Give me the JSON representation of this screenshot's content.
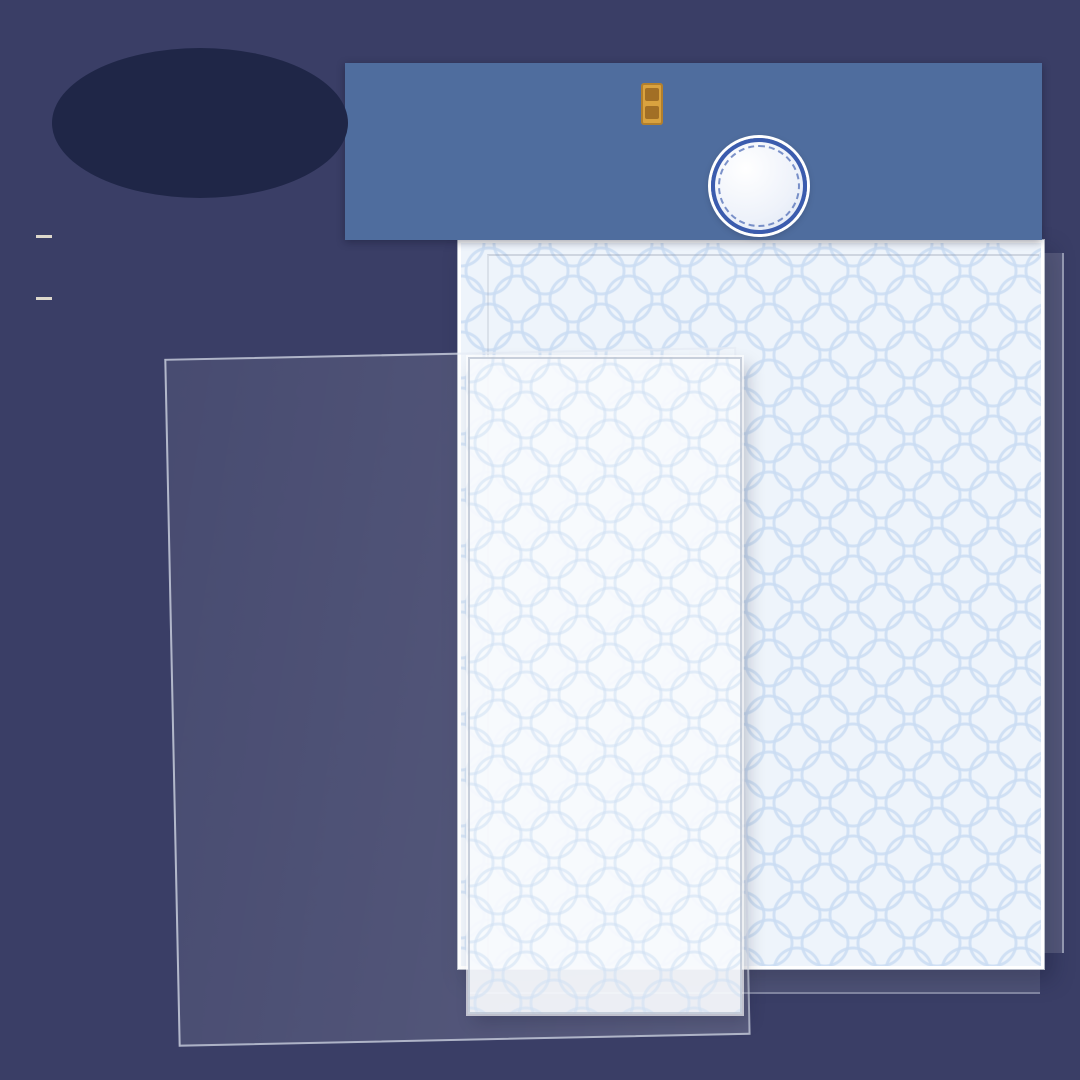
{
  "page": {
    "bg": "#3a3e66"
  },
  "store_badge": {
    "line1": "Treasure",
    "line2": "Store",
    "bg": "#1f2647",
    "text_color": "#f3ecd9"
  },
  "specs": [
    {
      "bullet": "•",
      "label": "scene card *1",
      "size": "140X180MM"
    },
    {
      "bullet": "•",
      "label": "PET sticker *2",
      "size": "125X150MM"
    }
  ],
  "banner": {
    "title_cn": "国风造景贴纸",
    "subtitle_line1": "Storage and Landscape",
    "subtitle_line2": "Stickers Series",
    "subtitle_cn": "珍宝阁篇",
    "version": "3.0",
    "bg": "#4f6d9e"
  },
  "palette": {
    "background": "#3a3e66",
    "banner_blue": "#4f6d9e",
    "badge_blue": "#2f55b4",
    "sheet_bg": "#eef4fb",
    "sheet_pattern": "#cbddf3",
    "capybara": "#cb8d58",
    "wood_dark": "#5d4a42",
    "wood_light": "#d9b98f",
    "jade": "#bfe0b0",
    "porcelain_blue": "#5b79b8"
  },
  "stickers": {
    "back": [
      {
        "k": "tassel",
        "n": "hanging-ornament",
        "x": 533,
        "y": 312,
        "w": 36,
        "h": 62
      },
      {
        "k": "tassel",
        "n": "hanging-ornament",
        "x": 585,
        "y": 292,
        "w": 36,
        "h": 62
      },
      {
        "k": "bowl",
        "n": "green-bowl",
        "x": 647,
        "y": 284,
        "w": 48,
        "h": 36,
        "c": "#9fd8b4"
      },
      {
        "k": "vase",
        "n": "cream-vase",
        "x": 643,
        "y": 330,
        "w": 38,
        "h": 50,
        "c": "#efe6c0"
      },
      {
        "k": "vase",
        "n": "green-vase",
        "x": 697,
        "y": 320,
        "w": 40,
        "h": 54,
        "c": "#abd8a2"
      },
      {
        "k": "jarmat",
        "n": "white-jar-on-blue-mat",
        "x": 750,
        "y": 296,
        "w": 54,
        "h": 52,
        "c": "#e8eef6",
        "c2": "#5b79b8"
      },
      {
        "k": "vase",
        "n": "cream-vase",
        "x": 812,
        "y": 296,
        "w": 38,
        "h": 52,
        "c": "#efe6c0"
      },
      {
        "k": "cyl",
        "n": "yellow-jar",
        "x": 867,
        "y": 324,
        "w": 48,
        "h": 60,
        "c": "#f2e6a8"
      },
      {
        "k": "topiary",
        "n": "potted-topiary",
        "x": 923,
        "y": 293,
        "w": 54,
        "h": 60
      },
      {
        "k": "jarmat",
        "n": "blue-jar-on-red-mat",
        "x": 980,
        "y": 328,
        "w": 50,
        "h": 48,
        "c": "#6f8fc4",
        "c2": "#c05a4a"
      },
      {
        "k": "drum",
        "n": "drum-stool",
        "x": 778,
        "y": 354,
        "w": 56,
        "h": 60,
        "c": "#4a4038"
      },
      {
        "k": "drum",
        "n": "drum-stool",
        "x": 837,
        "y": 388,
        "w": 54,
        "h": 58,
        "c": "#4a4038"
      },
      {
        "k": "plum",
        "n": "plum-blossom-vase",
        "x": 920,
        "y": 364,
        "w": 66,
        "h": 78
      },
      {
        "k": "drum",
        "n": "drum-stool",
        "x": 720,
        "y": 394,
        "w": 58,
        "h": 62,
        "c": "#7a4f3a"
      },
      {
        "k": "wallart",
        "n": "wall-hanging",
        "x": 972,
        "y": 410,
        "w": 48,
        "h": 58
      },
      {
        "k": "plate",
        "n": "green-plate",
        "x": 893,
        "y": 440,
        "w": 68,
        "h": 42,
        "c": "#cde08a"
      },
      {
        "k": "platerack",
        "n": "plate-rack",
        "x": 767,
        "y": 448,
        "w": 76,
        "h": 54
      },
      {
        "k": "tray",
        "n": "tea-tray",
        "x": 963,
        "y": 488,
        "w": 66,
        "h": 50
      },
      {
        "k": "capypeek",
        "n": "capybara-back",
        "x": 840,
        "y": 506,
        "w": 78,
        "h": 68
      },
      {
        "k": "stonejar",
        "n": "go-stone-jar",
        "x": 918,
        "y": 504,
        "w": 26,
        "h": 28
      },
      {
        "k": "tray",
        "n": "tea-tray",
        "x": 999,
        "y": 489,
        "w": 56,
        "h": 44
      },
      {
        "k": "capysleep",
        "n": "sleeping-capybara",
        "x": 747,
        "y": 557,
        "w": 94,
        "h": 64
      },
      {
        "k": "bowldark",
        "n": "stone-bowl",
        "x": 922,
        "y": 566,
        "w": 42,
        "h": 30
      },
      {
        "k": "bowldark",
        "n": "stone-bowl",
        "x": 997,
        "y": 551,
        "w": 46,
        "h": 32
      },
      {
        "k": "capy",
        "n": "capybara-with-cup",
        "x": 833,
        "y": 598,
        "w": 88,
        "h": 96,
        "o": "cup"
      },
      {
        "k": "tray",
        "n": "tea-set-tray",
        "x": 1002,
        "y": 613,
        "w": 64,
        "h": 46
      },
      {
        "k": "capy",
        "n": "capybara",
        "x": 923,
        "y": 632,
        "w": 80,
        "h": 90
      },
      {
        "k": "capy",
        "n": "capybara-with-leaf",
        "x": 743,
        "y": 652,
        "w": 90,
        "h": 82,
        "o": "hat"
      },
      {
        "k": "stones",
        "n": "go-stones",
        "x": 998,
        "y": 682,
        "w": 54,
        "h": 58
      },
      {
        "k": "capy",
        "n": "capybara-with-radish",
        "x": 842,
        "y": 700,
        "w": 84,
        "h": 86,
        "o": "cup"
      },
      {
        "k": "lotus",
        "n": "lotus-plant",
        "x": 928,
        "y": 716,
        "w": 52,
        "h": 46
      },
      {
        "k": "lilypad",
        "n": "lily-pads",
        "x": 737,
        "y": 728,
        "w": 66,
        "h": 42
      },
      {
        "k": "disc",
        "n": "jade-bi-disc",
        "x": 793,
        "y": 778,
        "w": 68,
        "h": 68
      },
      {
        "k": "box",
        "n": "wooden-chest",
        "x": 870,
        "y": 784,
        "w": 58,
        "h": 68
      },
      {
        "k": "box",
        "n": "wooden-chest",
        "x": 940,
        "y": 786,
        "w": 58,
        "h": 68
      },
      {
        "k": "lotus",
        "n": "lotus-flower",
        "x": 1012,
        "y": 763,
        "w": 42,
        "h": 46
      },
      {
        "k": "table",
        "n": "side-table",
        "x": 830,
        "y": 870,
        "w": 84,
        "h": 80,
        "c": "#8a6a4f",
        "c2": "#b05848"
      },
      {
        "k": "table",
        "n": "side-table",
        "x": 922,
        "y": 868,
        "w": 82,
        "h": 78,
        "c": "#a06a56",
        "c2": "#7fae73"
      },
      {
        "k": "basin",
        "n": "bronze-basin-stand",
        "x": 1010,
        "y": 868,
        "w": 62,
        "h": 72
      },
      {
        "k": "standtable",
        "n": "tall-table",
        "x": 748,
        "y": 852,
        "w": 62,
        "h": 92
      }
    ],
    "scene": [
      {
        "k": "crest",
        "n": "cloud-crest",
        "x": 308,
        "y": 392,
        "w": 430,
        "h": 178
      },
      {
        "k": "etagere",
        "n": "display-shelf",
        "x": 286,
        "y": 506,
        "w": 170,
        "h": 230
      },
      {
        "k": "goboard",
        "n": "go-table",
        "x": 442,
        "y": 426,
        "w": 140,
        "h": 98
      },
      {
        "k": "scroll",
        "n": "hanging-scroll",
        "x": 412,
        "y": 550,
        "w": 60,
        "h": 130,
        "c": "#d9c08e"
      },
      {
        "k": "scroll",
        "n": "hanging-scroll",
        "x": 478,
        "y": 526,
        "w": 48,
        "h": 96,
        "c": "#7fa8c9"
      },
      {
        "k": "bench",
        "n": "wooden-bench",
        "x": 282,
        "y": 616,
        "w": 120,
        "h": 50
      },
      {
        "k": "bench",
        "n": "wooden-bench",
        "x": 336,
        "y": 646,
        "w": 120,
        "h": 50
      }
    ],
    "front": [
      {
        "k": "scroll",
        "n": "hanging-scroll",
        "x": 474,
        "y": 444,
        "w": 62,
        "h": 126,
        "c": "#8d99a6"
      },
      {
        "k": "scroll",
        "n": "hanging-scroll",
        "x": 598,
        "y": 434,
        "w": 60,
        "h": 122,
        "c": "#8d99a6"
      },
      {
        "k": "scroll",
        "n": "hanging-scroll",
        "x": 668,
        "y": 500,
        "w": 56,
        "h": 116,
        "c": "#8d99a6"
      },
      {
        "k": "vase",
        "n": "blue-vase",
        "x": 590,
        "y": 352,
        "w": 36,
        "h": 48,
        "c": "#7a97c9"
      },
      {
        "k": "porc",
        "n": "porcelain-vase",
        "x": 508,
        "y": 470,
        "w": 52,
        "h": 110
      },
      {
        "k": "porc",
        "n": "porcelain-vase",
        "x": 572,
        "y": 458,
        "w": 46,
        "h": 96
      },
      {
        "k": "porc",
        "n": "porcelain-vase",
        "x": 642,
        "y": 444,
        "w": 42,
        "h": 88
      },
      {
        "k": "mirror",
        "n": "oval-mirror",
        "x": 630,
        "y": 534,
        "w": 88,
        "h": 106
      },
      {
        "k": "pipa",
        "n": "pipa-lute",
        "x": 534,
        "y": 558,
        "w": 76,
        "h": 96,
        "r": -18
      },
      {
        "k": "pipa",
        "n": "pipa-lute",
        "x": 690,
        "y": 680,
        "w": 70,
        "h": 92,
        "r": 14
      },
      {
        "k": "tray",
        "n": "tea-tray",
        "x": 702,
        "y": 490,
        "w": 62,
        "h": 46
      },
      {
        "k": "boat",
        "n": "wooden-boat",
        "x": 568,
        "y": 602,
        "w": 190,
        "h": 96
      },
      {
        "k": "capy",
        "n": "capybara-with-cup",
        "x": 664,
        "y": 614,
        "w": 92,
        "h": 100,
        "o": "hat cup"
      },
      {
        "k": "capysleep",
        "n": "sleeping-capybara",
        "x": 552,
        "y": 650,
        "w": 96,
        "h": 66
      },
      {
        "k": "capypeek",
        "n": "capybara-back",
        "x": 734,
        "y": 556,
        "w": 70,
        "h": 62
      },
      {
        "k": "steps",
        "n": "white-steps",
        "x": 502,
        "y": 646,
        "w": 74,
        "h": 86
      },
      {
        "k": "shelfgray",
        "n": "display-stand",
        "x": 614,
        "y": 694,
        "w": 132,
        "h": 122
      },
      {
        "k": "sideboard",
        "n": "tea-sideboard",
        "x": 660,
        "y": 768,
        "w": 138,
        "h": 82
      },
      {
        "k": "drum",
        "n": "drum-stool",
        "x": 537,
        "y": 744,
        "w": 58,
        "h": 52,
        "c": "#7a5b44"
      },
      {
        "k": "screen3",
        "n": "folding-screen",
        "x": 462,
        "y": 758,
        "w": 98,
        "h": 118
      },
      {
        "k": "capy",
        "n": "capybara-with-hat",
        "x": 549,
        "y": 798,
        "w": 82,
        "h": 88,
        "o": "hat"
      },
      {
        "k": "boat",
        "n": "wooden-boat",
        "x": 532,
        "y": 840,
        "w": 182,
        "h": 82
      },
      {
        "k": "lilypad",
        "n": "lily-pad",
        "x": 598,
        "y": 713,
        "w": 46,
        "h": 30
      },
      {
        "k": "lilypad",
        "n": "lily-pads",
        "x": 727,
        "y": 726,
        "w": 64,
        "h": 40
      },
      {
        "k": "stonejar",
        "n": "small-jar",
        "x": 694,
        "y": 708,
        "w": 26,
        "h": 28
      }
    ],
    "fore": [
      {
        "k": "cabinetp",
        "n": "planter-cabinet",
        "x": 226,
        "y": 870,
        "w": 94,
        "h": 94
      },
      {
        "k": "platform",
        "n": "wooden-platform",
        "x": 278,
        "y": 954,
        "w": 280,
        "h": 136
      },
      {
        "k": "windowo",
        "n": "lattice-window",
        "x": 382,
        "y": 894,
        "w": 98,
        "h": 120
      },
      {
        "k": "chaise",
        "n": "daybed",
        "x": 448,
        "y": 974,
        "w": 184,
        "h": 98
      },
      {
        "k": "stand",
        "n": "plant-stand",
        "x": 557,
        "y": 858,
        "w": 72,
        "h": 138
      },
      {
        "k": "stand",
        "n": "plant-stand",
        "x": 647,
        "y": 860,
        "w": 72,
        "h": 138
      },
      {
        "k": "stand",
        "n": "plant-stand",
        "x": 739,
        "y": 860,
        "w": 68,
        "h": 132
      },
      {
        "k": "tree",
        "n": "pine-tree",
        "x": 642,
        "y": 944,
        "w": 250,
        "h": 190
      },
      {
        "k": "lanternb",
        "n": "blue-lantern",
        "x": 562,
        "y": 970,
        "w": 64,
        "h": 92
      }
    ]
  }
}
